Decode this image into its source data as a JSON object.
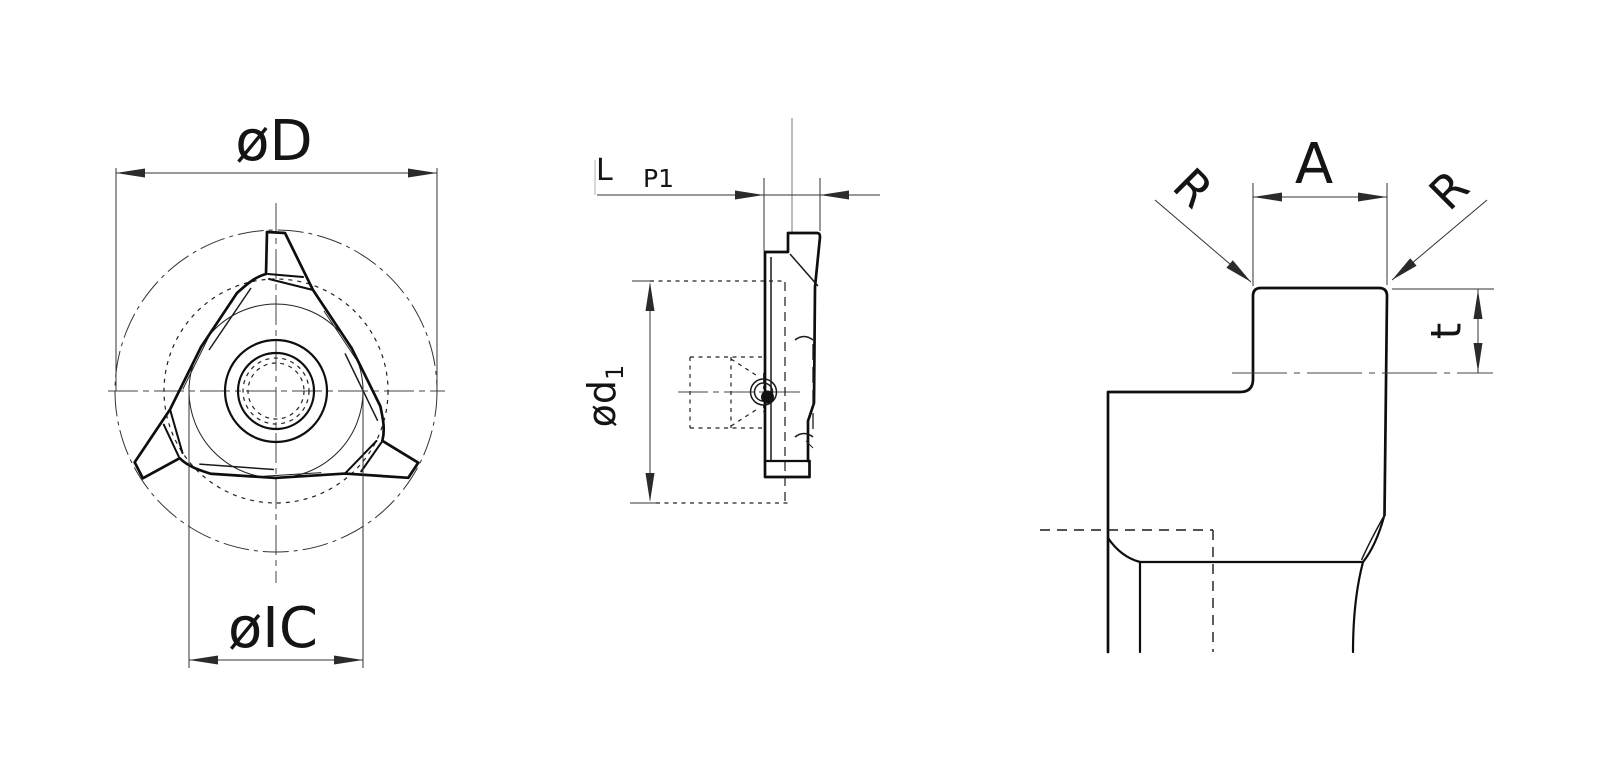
{
  "drawing": {
    "title": "insert-technical-drawing",
    "ink_color": "#0e0e0e",
    "dim_color": "#333333",
    "front_view": {
      "dim_outer_diameter": "øD",
      "dim_inscribed_circle": "øIC"
    },
    "side_view": {
      "dim_length": "L",
      "dim_pitch": "P1",
      "dim_bore_prefix": "ød",
      "dim_bore_subscript": "1"
    },
    "profile_view": {
      "dim_radius_left": "R",
      "dim_width": "A",
      "dim_radius_right": "R",
      "dim_depth": "t"
    }
  }
}
